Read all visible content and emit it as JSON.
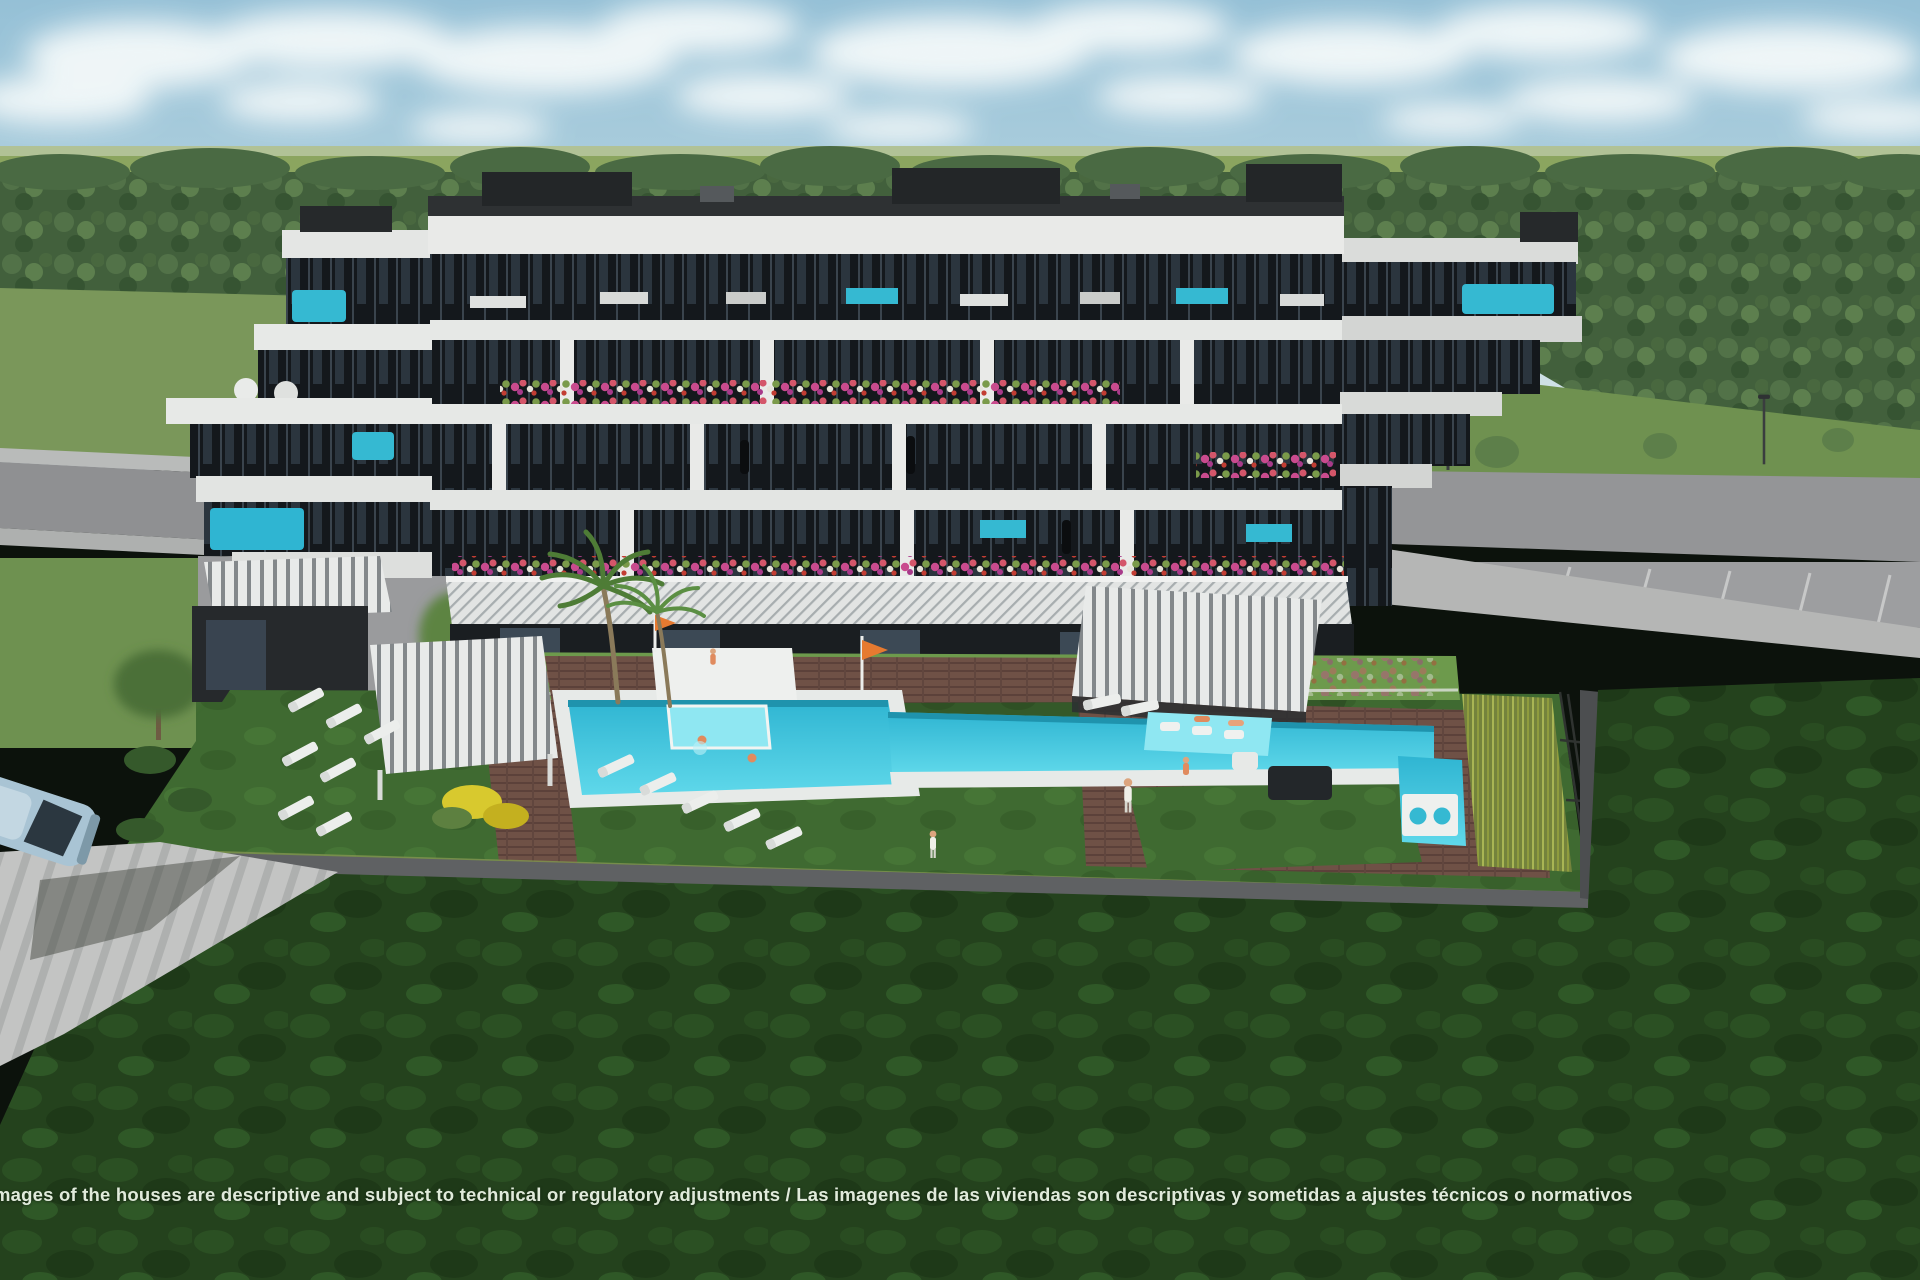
{
  "disclaimer": {
    "text": "mages of the houses are descriptive and subject to technical or regulatory adjustments / Las imagenes de las viviendas son descriptivas y sometidas a ajustes técnicos o normativos"
  },
  "scene": {
    "subject": "3D architectural render of a modern white-and-dark apartment block with communal pool garden",
    "colors": {
      "sky_top": "#9cc6da",
      "sky_horizon": "#dfe9ea",
      "cloud": "#f6fafa",
      "distant_field": "#8ba55f",
      "forest": "#42603c",
      "mid_lawn": "#7a975a",
      "amenity_lawn": "#3f6a31",
      "foreground_grass": "#24421d",
      "building_white": "#e9eae8",
      "glazing_dark": "#15191d",
      "pool_water": "#3cc7dc",
      "deck_wood": "#6f5146",
      "road_gray": "#95969a",
      "wall_gray": "#5f6163",
      "car_blue": "#a9c4d4",
      "accent_teal": "#35b9d2",
      "flower_pink": "#c94b8e",
      "reed_green": "#a8b554",
      "flag_orange": "#e67a30"
    }
  }
}
